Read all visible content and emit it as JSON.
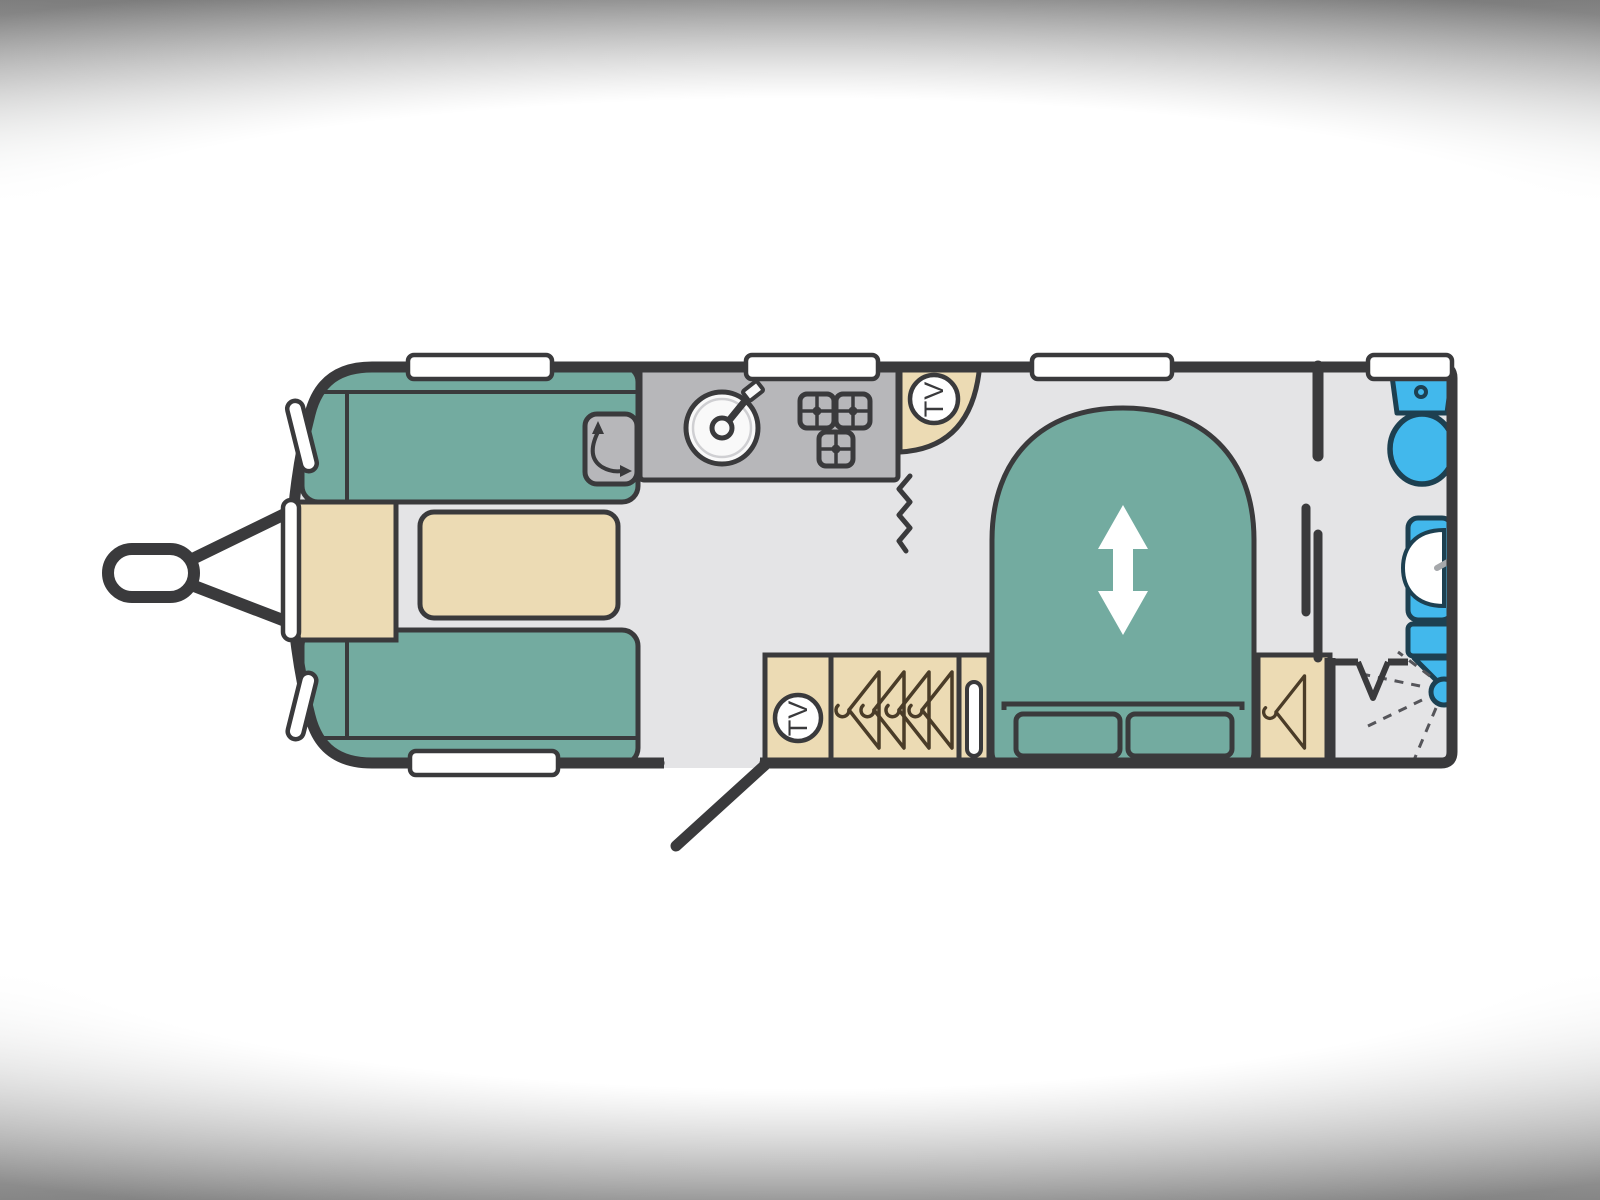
{
  "colors": {
    "wall": "#3a3a3c",
    "floor": "#e4e4e6",
    "teal": "#73aba0",
    "beige": "#ecdbb4",
    "gray": "#b7b7ba",
    "grayLight": "#cfcfd2",
    "blue": "#42b8ec",
    "blueDark": "#1d4051",
    "white": "#ffffff",
    "sink": "#f9f9f9",
    "hanger": "#4a3c28",
    "spray": "#55555a",
    "tap": "#a6a8ab"
  },
  "plan": {
    "kind": "caravan-floorplan",
    "tv_label": "TV",
    "areas": [
      "front-lounge",
      "kitchen",
      "bedroom-island-bed",
      "washroom"
    ],
    "features": {
      "front_lounge": [
        "sofa-top",
        "sofa-bottom",
        "front-chest",
        "table",
        "swivel-worktop"
      ],
      "kitchen": [
        "round-sink",
        "three-burner-hob",
        "corner-tv-point"
      ],
      "bedroom": [
        "tv-point-cabinet",
        "wardrobe-4-hangers",
        "drawer-unit",
        "island-bed-sliding",
        "bedside-wardrobe"
      ],
      "washroom": [
        "toilet",
        "washbasin-vanity",
        "shower-head",
        "bifold-door",
        "sliding-partition"
      ],
      "exterior": [
        "tow-hitch",
        "entrance-door",
        "windows"
      ]
    }
  }
}
